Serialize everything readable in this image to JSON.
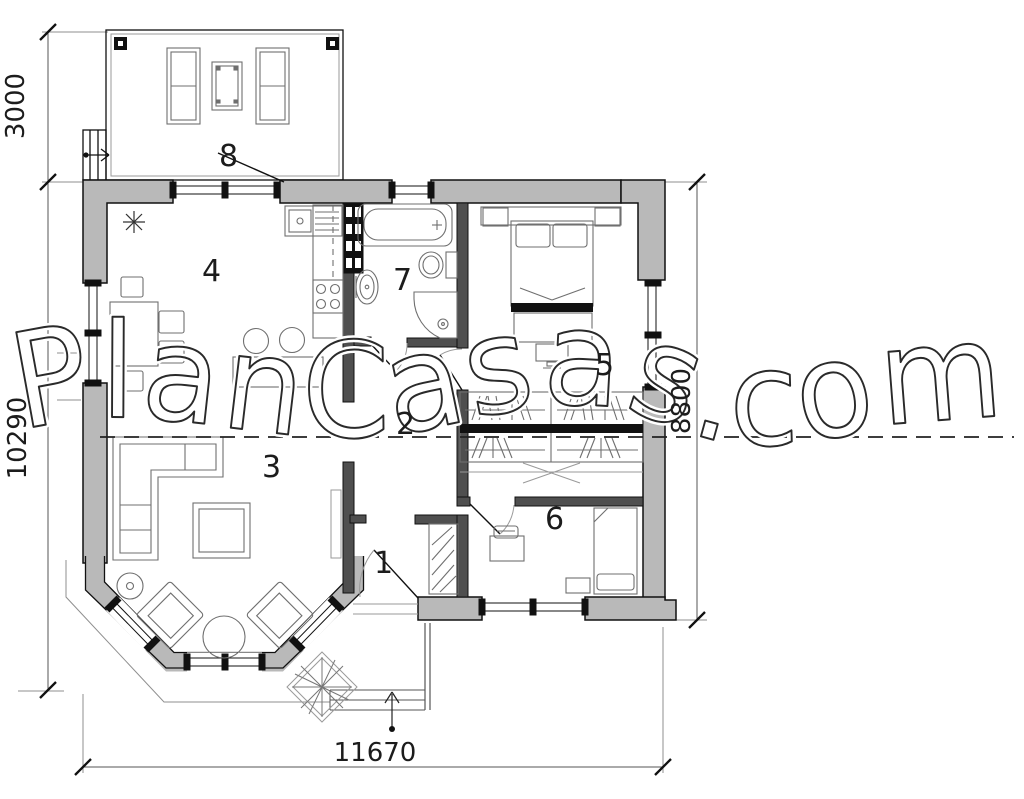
{
  "watermark": {
    "text": "PlanCasas.com"
  },
  "rooms": [
    {
      "number": "1"
    },
    {
      "number": "2"
    },
    {
      "number": "3"
    },
    {
      "number": "4"
    },
    {
      "number": "5"
    },
    {
      "number": "6"
    },
    {
      "number": "7"
    },
    {
      "number": "8"
    }
  ],
  "dimensions": {
    "terrace_depth": "3000",
    "left_height": "10290",
    "right_height": "8800",
    "bottom_width": "11670"
  },
  "colors": {
    "wall_fill": "#b9b9b9",
    "partition_fill": "#4f4f4f",
    "line": "#111111",
    "furniture": "#6f6f6f",
    "dimension": "#3c3c3c",
    "background": "#ffffff"
  }
}
